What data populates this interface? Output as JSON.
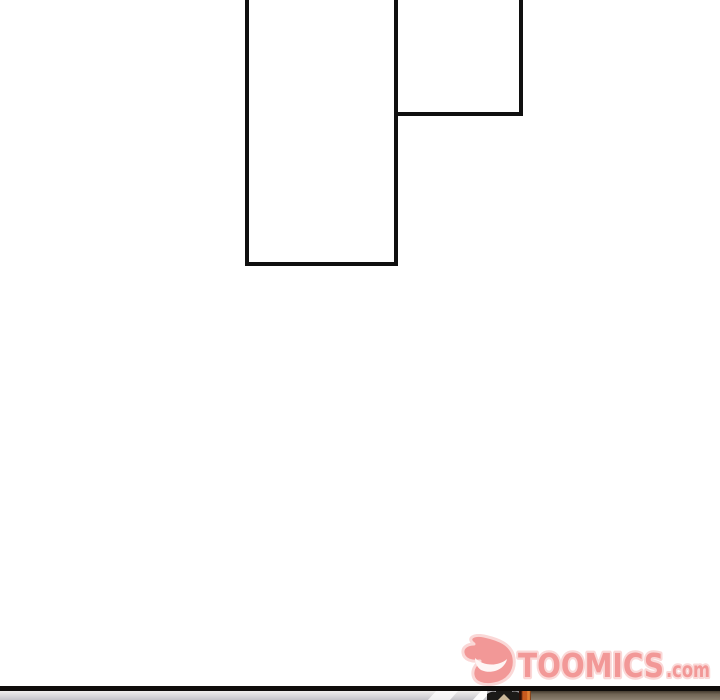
{
  "page": {
    "background": "#ffffff",
    "kind": "comic-page"
  },
  "panels": [
    {
      "name": "tall-empty-panel",
      "content": ""
    },
    {
      "name": "small-empty-panel",
      "content": ""
    }
  ],
  "watermark": {
    "brand": "TOOMICS",
    "suffix": ".com",
    "fill": "#F29392",
    "outline": "#FAD6D5",
    "grin": "#FEF6F5",
    "icon": "toomics-devil-mascot-icon"
  },
  "next_panel_preview": {
    "border_color": "#0f0d0b",
    "wall_gray": "#c9c8cc",
    "hair_dark": "#1b1a18",
    "skin_tan": "#cbb89a",
    "accent_orange": "#c85a1e",
    "wood_brown": "#7d7262"
  }
}
